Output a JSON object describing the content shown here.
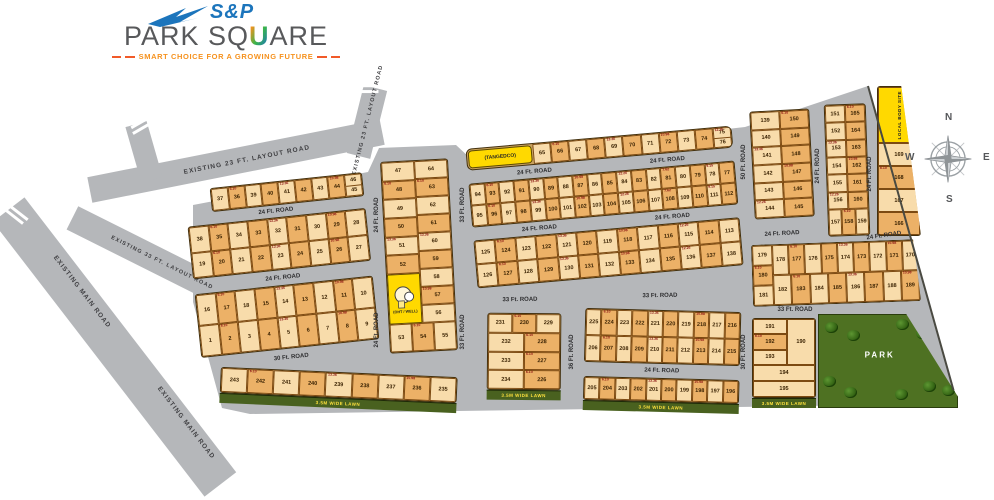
{
  "logo": {
    "sp": "S&P",
    "name_pre": "PARK SQ",
    "name_u": "U",
    "name_post": "ARE",
    "tagline": "SMART CHOICE FOR A GROWING FUTURE"
  },
  "compass": {
    "n": "N",
    "s": "S",
    "e": "E",
    "w": "W"
  },
  "roads": {
    "existing_main": "EXISTING MAIN ROAD",
    "existing_23": "EXISTING 23 FT. LAYOUT ROAD",
    "existing_33": "EXISTING 33 FT. LAYOUT ROAD",
    "r24": "24 Ft. ROAD",
    "r30": "30 Ft. ROAD",
    "r33": "33 Ft. ROAD",
    "r36": "36 Ft. ROAD",
    "r50": "50 Ft. ROAD",
    "lawn": "3.5M WIDE LAWN"
  },
  "special": {
    "tangedco": "(TANGEDCO)",
    "oht": "(OHT / WELL)",
    "local_body": "LOCAL BODY SITE",
    "park": "PARK"
  },
  "dimension_samples": [
    "9.15",
    "6.10",
    "12.26",
    "10.06",
    "13.36",
    "7.62",
    "12.34",
    "10.98"
  ],
  "blocks": {
    "a": {
      "row1": [
        "37",
        "36",
        "39",
        "40",
        "41",
        "42",
        "43",
        "44",
        "46/45"
      ],
      "row2": [
        "38",
        "35",
        "34",
        "33",
        "32",
        "31",
        "30",
        "29",
        "28"
      ],
      "row3": [
        "19",
        "20",
        "21",
        "22",
        "23",
        "24",
        "25",
        "26",
        "27"
      ],
      "row4": [
        "16",
        "17",
        "18",
        "15",
        "14",
        "13",
        "12",
        "11",
        "10"
      ],
      "row5": [
        "1",
        "2",
        "3",
        "4",
        "5",
        "6",
        "7",
        "8",
        "9"
      ],
      "row6": [
        "243",
        "242",
        "241",
        "240",
        "239",
        "238",
        "237",
        "236",
        "235"
      ]
    },
    "b": {
      "col_left": [
        "47",
        "48",
        "49",
        "50",
        "51",
        "52"
      ],
      "col_right": [
        "64",
        "63",
        "62",
        "61",
        "60",
        "59",
        "58",
        "57",
        "56"
      ],
      "row_bottom": [
        "53",
        "54",
        "55"
      ]
    },
    "c": {
      "row_top": [
        "65",
        "66",
        "67",
        "68",
        "69",
        "70",
        "71",
        "72",
        "73",
        "74",
        "75/76"
      ],
      "row1": [
        "94",
        "93",
        "92",
        "91",
        "90",
        "89",
        "88",
        "87",
        "86",
        "85",
        "84",
        "83",
        "82",
        "81",
        "80",
        "79",
        "78",
        "77"
      ],
      "row2": [
        "95",
        "96",
        "97",
        "98",
        "99",
        "100",
        "101",
        "102",
        "103",
        "104",
        "105",
        "106",
        "107",
        "108",
        "109",
        "110",
        "111",
        "112"
      ],
      "row3": [
        "125",
        "124",
        "123",
        "122",
        "121",
        "120",
        "119",
        "118",
        "117",
        "116",
        "115",
        "114",
        "113"
      ],
      "row4": [
        "126",
        "127",
        "128",
        "129",
        "130",
        "131",
        "132",
        "133",
        "134",
        "135",
        "136",
        "137",
        "138"
      ]
    },
    "c_bottom_small": {
      "row1": [
        "231",
        "230",
        "229"
      ],
      "row2": [
        "232",
        "228"
      ],
      "row3": [
        "233",
        "227"
      ],
      "row4": [
        "234",
        "226"
      ]
    },
    "c_bottom_big": {
      "row1": [
        "225",
        "224",
        "223",
        "222",
        "221",
        "220",
        "219",
        "218",
        "217",
        "216"
      ],
      "row2": [
        "206",
        "207",
        "208",
        "209",
        "210",
        "211",
        "212",
        "213",
        "214",
        "215"
      ],
      "row3": [
        "205",
        "204",
        "203",
        "202",
        "201",
        "200",
        "199",
        "198",
        "197",
        "196"
      ]
    },
    "d": {
      "cells": [
        "139",
        "150",
        "140",
        "149",
        "141",
        "148",
        "142",
        "147",
        "143",
        "146",
        "144",
        "145"
      ]
    },
    "e": {
      "cells": [
        "151",
        "165",
        "152",
        "164",
        "153",
        "163",
        "154",
        "162",
        "155",
        "161",
        "156",
        "160"
      ],
      "row_bottom": [
        "157",
        "158",
        "159"
      ]
    },
    "f": {
      "col": [
        "169",
        "168",
        "167",
        "166"
      ]
    },
    "g": {
      "col_left": [
        "179",
        "180",
        "181"
      ],
      "row_top": [
        "178",
        "177",
        "176",
        "175",
        "174",
        "173",
        "172",
        "171",
        "170"
      ],
      "row_bottom": [
        "182",
        "183",
        "184",
        "185",
        "186",
        "187",
        "188",
        "189"
      ]
    },
    "h": {
      "col_left": [
        "191",
        "192",
        "193"
      ],
      "tall": [
        "190"
      ],
      "row_a": [
        "194"
      ],
      "row_b": [
        "195"
      ]
    }
  },
  "colors": {
    "plot_light": "#f8dcab",
    "plot_dark": "#ecb167",
    "road_gray": "#b5b7ba",
    "special_yellow": "#ffd900",
    "park_green": "#4e7122",
    "lawn_green": "#49611f",
    "logo_blue": "#1c75bc",
    "logo_gray": "#58595b",
    "logo_orange": "#f6921e"
  }
}
